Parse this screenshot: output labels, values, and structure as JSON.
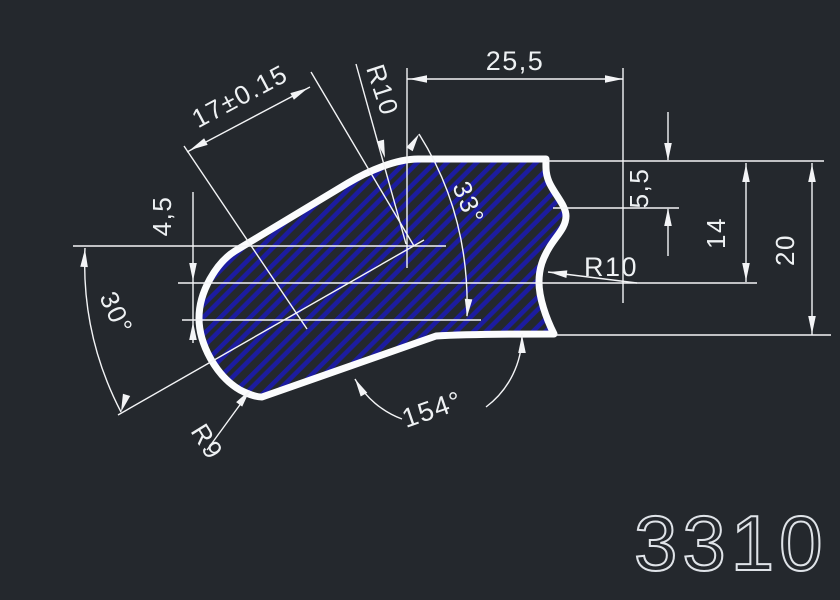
{
  "canvas": {
    "background_color": "#24282d",
    "entity_color": "#f3f4f6",
    "hatch_color": "#1c1ca0",
    "part_number": "3310",
    "part_number_color": "#dfe3e8"
  },
  "dimensions": [
    {
      "id": "width-25-5",
      "label": "25,5",
      "type": "linear",
      "x": 515,
      "y": 70,
      "rot": 0,
      "fs": 27,
      "anchor": "middle"
    },
    {
      "id": "length-17",
      "label": "17±0.15",
      "type": "linear",
      "x": 244,
      "y": 104,
      "rot": -28,
      "fs": 26,
      "anchor": "middle"
    },
    {
      "id": "radius-top-r10",
      "label": "R10",
      "type": "radius",
      "x": 366,
      "y": 68,
      "rot": 72,
      "fs": 26,
      "anchor": "start"
    },
    {
      "id": "angle-33",
      "label": "33°",
      "type": "angular",
      "x": 452,
      "y": 186,
      "rot": 68,
      "fs": 26,
      "anchor": "start"
    },
    {
      "id": "height-5-5",
      "label": "5,5",
      "type": "linear",
      "x": 648,
      "y": 188,
      "rot": -90,
      "fs": 26,
      "anchor": "middle"
    },
    {
      "id": "height-14",
      "label": "14",
      "type": "linear",
      "x": 725,
      "y": 233,
      "rot": -90,
      "fs": 26,
      "anchor": "middle"
    },
    {
      "id": "height-20",
      "label": "20",
      "type": "linear",
      "x": 794,
      "y": 250,
      "rot": -90,
      "fs": 26,
      "anchor": "middle"
    },
    {
      "id": "radius-notch-r10",
      "label": "R10",
      "type": "radius",
      "x": 584,
      "y": 276,
      "rot": 0,
      "fs": 27,
      "anchor": "start"
    },
    {
      "id": "height-4-5",
      "label": "4,5",
      "type": "linear",
      "x": 171,
      "y": 216,
      "rot": -90,
      "fs": 26,
      "anchor": "middle"
    },
    {
      "id": "angle-30",
      "label": "30°",
      "type": "angular",
      "x": 99,
      "y": 297,
      "rot": 65,
      "fs": 26,
      "anchor": "start"
    },
    {
      "id": "radius-r9",
      "label": "R9",
      "type": "radius",
      "x": 190,
      "y": 431,
      "rot": 58,
      "fs": 26,
      "anchor": "start"
    },
    {
      "id": "angle-154",
      "label": "154°",
      "type": "angular",
      "x": 406,
      "y": 428,
      "rot": -19,
      "fs": 27,
      "anchor": "start"
    }
  ],
  "part_label": {
    "text": "3310",
    "x": 634,
    "y": 570,
    "fs": 78
  }
}
